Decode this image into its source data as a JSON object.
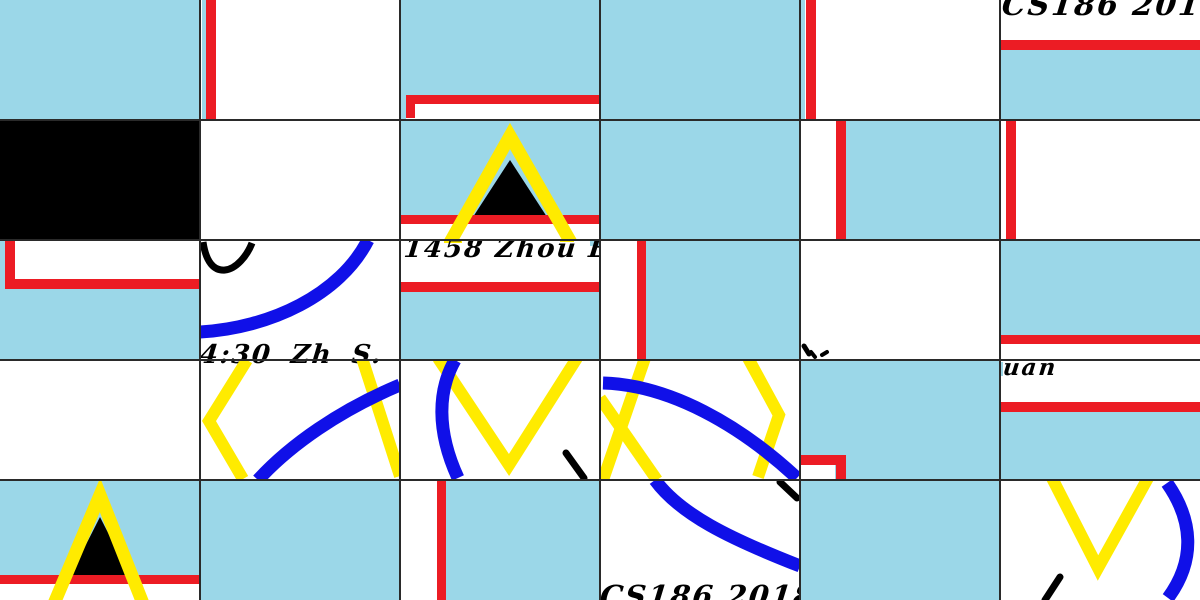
{
  "colors": {
    "sky": "#9BD7E8",
    "red": "#EC1C24",
    "yellow": "#FFEB00",
    "blue": "#1010E8",
    "ink": "#000000",
    "paper": "#FFFFFF",
    "line": "#2A2A2A"
  },
  "grid": {
    "cols": 6,
    "rows": 5,
    "tile_width": 200,
    "tile_height": 120
  },
  "texts": {
    "cs186_top": "CS186  201801",
    "id_name": "1458  Zhou EnX",
    "time_name": "4:30   Zh    S. Y",
    "name_tail": "uan",
    "cs186_bottom": "CS186  201801"
  },
  "tiles": [
    {
      "pos": "r0c0",
      "bg": "sky",
      "features": []
    },
    {
      "pos": "r0c1",
      "bg": "paper",
      "features": [
        "sky-sliver-left",
        "red-vertical-bar"
      ]
    },
    {
      "pos": "r0c2",
      "bg": "sky",
      "features": [
        "red-frame-corner-top-left",
        "white-strip-bottom"
      ]
    },
    {
      "pos": "r0c3",
      "bg": "sky",
      "features": []
    },
    {
      "pos": "r0c4",
      "bg": "paper",
      "features": [
        "sky-sliver-left",
        "red-vertical-bar"
      ]
    },
    {
      "pos": "r0c5",
      "bg": "paper",
      "features": [
        "handwriting-cs186-top",
        "red-stripe",
        "sky-lower"
      ]
    },
    {
      "pos": "r1c0",
      "bg": "ink",
      "features": [
        "solid-black-tile"
      ]
    },
    {
      "pos": "r1c1",
      "bg": "paper",
      "features": []
    },
    {
      "pos": "r1c2",
      "bg": "sky",
      "features": [
        "yellow-triangle",
        "black-triangle",
        "red-stripe",
        "white-strip-bottom"
      ]
    },
    {
      "pos": "r1c3",
      "bg": "sky",
      "features": []
    },
    {
      "pos": "r1c4",
      "bg": "sky",
      "features": [
        "white-strip-left",
        "red-vertical-bar"
      ]
    },
    {
      "pos": "r1c5",
      "bg": "paper",
      "features": [
        "red-vertical-bar"
      ]
    },
    {
      "pos": "r2c0",
      "bg": "sky",
      "features": [
        "red-frame-corner-bottom-left",
        "white-area",
        "sky-lower"
      ]
    },
    {
      "pos": "r2c1",
      "bg": "paper",
      "features": [
        "black-arc",
        "blue-arc",
        "handwriting-time-name-top-half"
      ]
    },
    {
      "pos": "r2c2",
      "bg": "paper",
      "features": [
        "handwriting-id-name",
        "yellow-tips",
        "red-stripe",
        "sky-lower"
      ]
    },
    {
      "pos": "r2c3",
      "bg": "sky",
      "features": [
        "white-strip-left",
        "red-vertical-bar"
      ]
    },
    {
      "pos": "r2c4",
      "bg": "paper",
      "features": [
        "ink-marks"
      ]
    },
    {
      "pos": "r2c5",
      "bg": "sky",
      "features": [
        "red-stripe",
        "white-strip-bottom"
      ]
    },
    {
      "pos": "r3c0",
      "bg": "paper",
      "features": []
    },
    {
      "pos": "r3c1",
      "bg": "paper",
      "features": [
        "handwriting-time-name-bottom-half",
        "yellow-chevron-left",
        "yellow-diagonal",
        "blue-arc"
      ]
    },
    {
      "pos": "r3c2",
      "bg": "paper",
      "features": [
        "yellow-v",
        "blue-arc",
        "ink-stroke"
      ]
    },
    {
      "pos": "r3c3",
      "bg": "paper",
      "features": [
        "yellow-x",
        "yellow-chevron-right",
        "blue-arc"
      ]
    },
    {
      "pos": "r3c4",
      "bg": "sky",
      "features": [
        "red-frame-corner-bottom-right",
        "white-area"
      ]
    },
    {
      "pos": "r3c5",
      "bg": "paper",
      "features": [
        "handwriting-name-tail",
        "red-stripe",
        "sky-lower"
      ]
    },
    {
      "pos": "r4c0",
      "bg": "sky",
      "features": [
        "yellow-triangle",
        "black-triangle",
        "red-stripe",
        "white-strip-bottom"
      ]
    },
    {
      "pos": "r4c1",
      "bg": "sky",
      "features": []
    },
    {
      "pos": "r4c2",
      "bg": "sky",
      "features": [
        "white-strip-left",
        "red-vertical-bar"
      ]
    },
    {
      "pos": "r4c3",
      "bg": "paper",
      "features": [
        "blue-arc",
        "ink-stroke",
        "handwriting-cs186-bottom"
      ]
    },
    {
      "pos": "r4c4",
      "bg": "sky",
      "features": []
    },
    {
      "pos": "r4c5",
      "bg": "paper",
      "features": [
        "yellow-v",
        "blue-arc",
        "ink-stroke"
      ]
    }
  ]
}
